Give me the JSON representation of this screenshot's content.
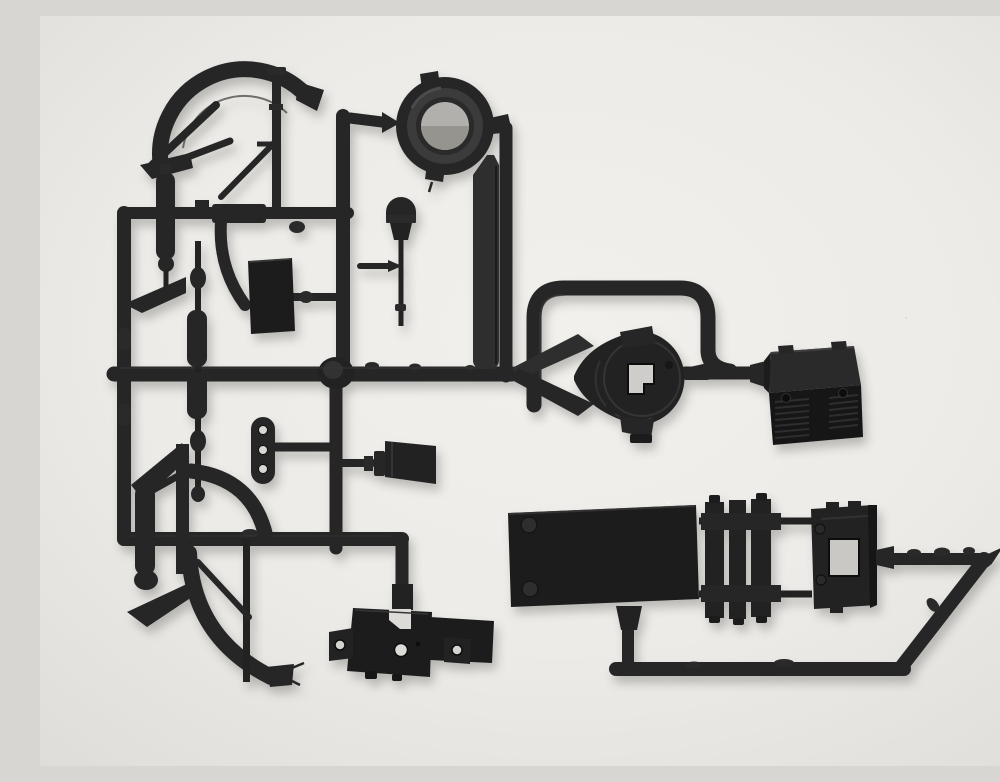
{
  "scene": {
    "description": "Photograph of an unassembled black plastic model-kit sprue (parts tree) lying on a neutral light-grey background",
    "background_color": "#edebe7",
    "background_edge_color": "#e0deda",
    "plastic_color": "#262626",
    "plastic_dark_color": "#161616",
    "plastic_highlight_color": "#3f3f3f",
    "hole_light_color": "#d5d3cf",
    "parts": [
      {
        "label": "sprue runner frame",
        "position": "spanning whole tree"
      },
      {
        "label": "ring hub / drum part",
        "position": "top centre"
      },
      {
        "label": "flat strip brace",
        "position": "below ring, on vertical runner"
      },
      {
        "label": "upper mudguard assembly with braces",
        "position": "top left"
      },
      {
        "label": "lower mudguard assembly with braces",
        "position": "bottom left"
      },
      {
        "label": "shock absorber cylinders",
        "position": "left column"
      },
      {
        "label": "small rectangular panel",
        "position": "centre left"
      },
      {
        "label": "three-hole link strap",
        "position": "centre left, below panel"
      },
      {
        "label": "gear-lever with round knob",
        "position": "centre top"
      },
      {
        "label": "stepped knob part",
        "position": "centre"
      },
      {
        "label": "roll-bar U tube",
        "position": "centre right"
      },
      {
        "label": "pulley / winch housing",
        "position": "centre right"
      },
      {
        "label": "vented battery box",
        "position": "right"
      },
      {
        "label": "chassis floor plate with rivets",
        "position": "bottom right"
      },
      {
        "label": "ladder frame section",
        "position": "bottom right, middle"
      },
      {
        "label": "window frame section",
        "position": "bottom right"
      },
      {
        "label": "mounting bracket plate with ears",
        "position": "bottom centre"
      }
    ]
  }
}
